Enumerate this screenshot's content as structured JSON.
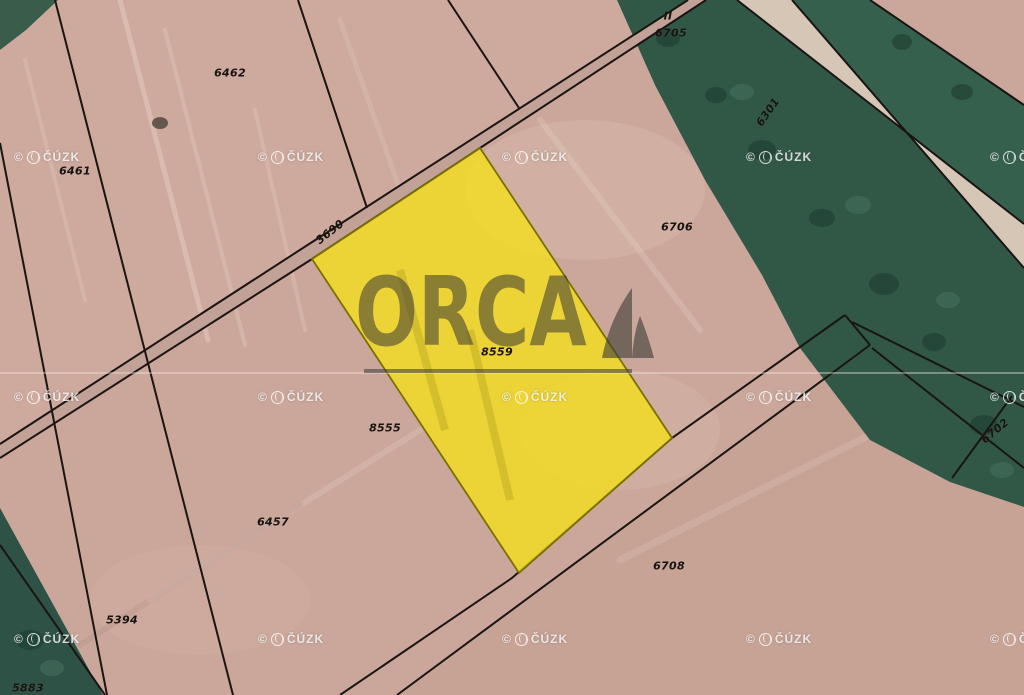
{
  "map": {
    "type": "cadastral-aerial-map",
    "watermark": {
      "copyright": "©",
      "text": "ČÚZK",
      "grid_x": [
        14,
        258,
        502,
        746,
        990
      ],
      "grid_y": [
        150,
        390,
        632
      ]
    },
    "logo": {
      "text": "ORCA"
    },
    "highlight_parcel_label": "8559",
    "parcel_labels": [
      {
        "text": "6462",
        "x": 230,
        "y": 73,
        "rot": 0
      },
      {
        "text": "6461",
        "x": 75,
        "y": 171,
        "rot": 0
      },
      {
        "text": "II",
        "x": 668,
        "y": 16,
        "rot": 0
      },
      {
        "text": "6705",
        "x": 671,
        "y": 33,
        "rot": 0
      },
      {
        "text": "6301",
        "x": 768,
        "y": 112,
        "rot": -55
      },
      {
        "text": "6706",
        "x": 677,
        "y": 227,
        "rot": 0
      },
      {
        "text": "3690",
        "x": 330,
        "y": 232,
        "rot": -38
      },
      {
        "text": "8559",
        "x": 497,
        "y": 352,
        "rot": 0
      },
      {
        "text": "8555",
        "x": 385,
        "y": 428,
        "rot": 0
      },
      {
        "text": "6702",
        "x": 995,
        "y": 431,
        "rot": -40
      },
      {
        "text": "6457",
        "x": 273,
        "y": 522,
        "rot": 0
      },
      {
        "text": "6708",
        "x": 669,
        "y": 566,
        "rot": 0
      },
      {
        "text": "5394",
        "x": 122,
        "y": 620,
        "rot": 0
      },
      {
        "text": "5883",
        "x": 28,
        "y": 688,
        "rot": 0
      }
    ],
    "colors": {
      "field_beige": "#cba79b",
      "field_path": "#c2a196",
      "road_surface": "#d5c6b5",
      "vegetation_dark": "#315847",
      "vegetation_darker": "#1e3c30",
      "boundary_black": "#1a1512",
      "highlight_yellow": "#f7e114",
      "watermark_white": "#ffffff",
      "logo_gray": "#3a3834"
    }
  }
}
